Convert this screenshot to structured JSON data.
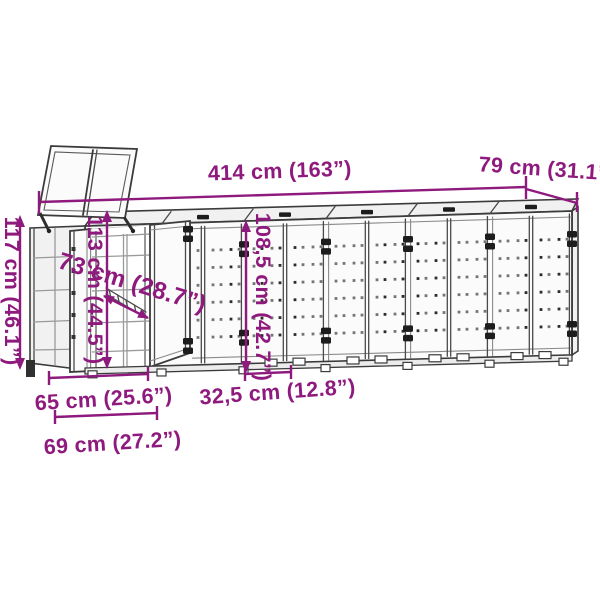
{
  "colors": {
    "dimension_accent": "#8F1A7E",
    "line": "#3B3B3B",
    "panel_fill": "#FBFBFB",
    "background": "#FFFFFF"
  },
  "dimensions": {
    "total_width": "414 cm (163”)",
    "depth": "79 cm (31.1”)",
    "total_height": "117 cm (46.1”)",
    "interior_height": "113 cm (44.5”)",
    "interior_depth": "73 cm (28.7”)",
    "door_height": "108,5 cm (42.7”)",
    "door_width": "32,5 cm (12.8”)",
    "opening_width": "65 cm (25.6”)",
    "module_width": "69 cm (27.2”)"
  }
}
